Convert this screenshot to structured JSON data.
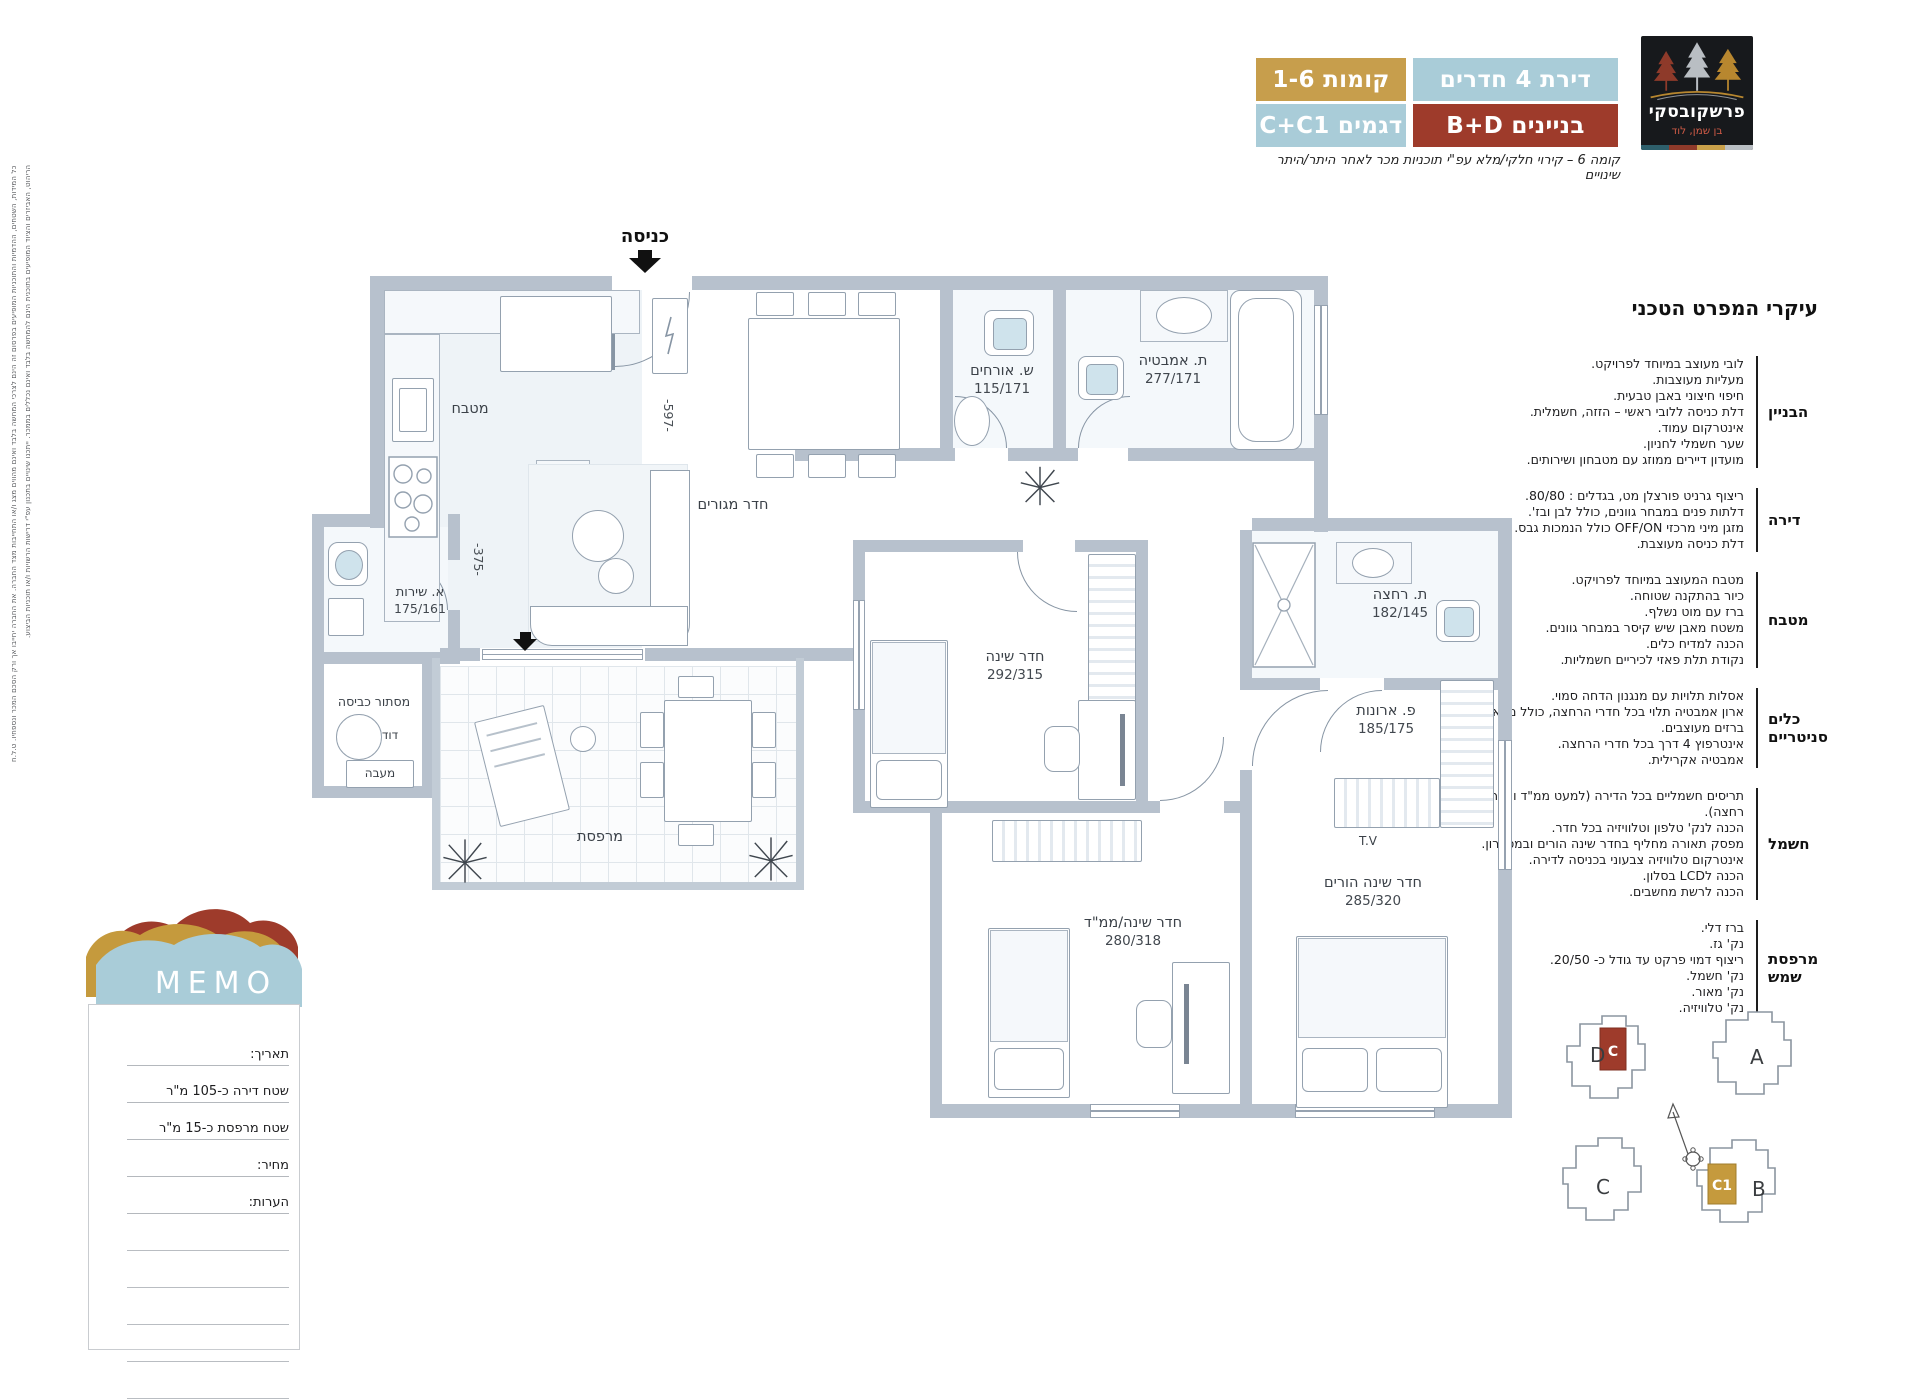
{
  "logo": {
    "brand": "פרשקובסקי",
    "location": "בן שמן, לוד"
  },
  "header": {
    "apartment": "דירת 4 חדרים",
    "floors": "קומות 1-6",
    "buildings": "בניינים B+D",
    "models": "דגמים C+C1",
    "note": "קומה 6 – קירוי חלקי/מלא עפ\"י תוכניות מכר לאחר היתר/היתר שינויים",
    "colors": {
      "blue": "#a9ccd8",
      "gold": "#c79e4c",
      "red": "#9e3b2b"
    }
  },
  "specs": {
    "title": "עיקרי המפרט הטכני",
    "sections": [
      {
        "label": "הבניין",
        "lines": [
          "לובי מעוצב במיוחד לפרויקט.",
          "מעליות מעוצבות.",
          "חיפוי חיצוני באבן טבעית.",
          "דלת כניסה ללובי ראשי – הזזה, חשמלית.",
          "אינטרקום עמוד.",
          "שער חשמלי לחניון.",
          "מועדון דיירים ממוזג עם מטבחון ושירותים."
        ]
      },
      {
        "label": "דירה",
        "lines": [
          "ריצוף גרניט פורצלן מט, בגדלים : 80/80.",
          "דלתות פנים במבחר גוונים, כולל לבן ובז'.",
          "מזגן מיני מרכזי OFF/ON כולל הנמכות גבס.",
          "דלת כניסה מעוצבת."
        ]
      },
      {
        "label": "מטבח",
        "lines": [
          "מטבח המעוצב במיוחד לפרויקט.",
          "כיור בהתקנה שטוחה.",
          "ברז עם מוט נשלף.",
          "משטח מאבן שיש קיסר במבחר גוונים.",
          "הכנה למדיח כלים.",
          "נקודת תלת פאזי לכיריים חשמליות."
        ]
      },
      {
        "label": "כלים סניטריים",
        "lines": [
          "אסלות תלויות עם מנגנון הדחה סמוי.",
          "ארון אמבטיה תלוי בכל חדרי הרחצה, כולל מראה.",
          "ברזים מעוצבים.",
          "אינטרפוץ 4 דרך בכל חדרי הרחצה.",
          "אמבטיה אקרילית."
        ]
      },
      {
        "label": "חשמל",
        "lines": [
          "תריסים חשמליים בכל הדירה (למעט ממ\"ד וחדרי רחצה).",
          "הכנה לנק' טלפון וטלוויזיה בכל חדר.",
          "מפסק תאורה מחליף בחדר שינה הורים ובמסדרון.",
          "אינטרקום טלוויזיה צבעוני בכניסה לדירה.",
          "הכנה לLCD בסלון.",
          "הכנה לרשת מחשבים."
        ]
      },
      {
        "label": "מרפסת שמש",
        "lines": [
          "ברז דלי.",
          "נק' גז.",
          "ריצוף דמוי פרקט עד גודל כ- 20/50.",
          "נק' חשמל.",
          "נק' מאור.",
          "נק' טלוויזיה."
        ]
      }
    ]
  },
  "plan": {
    "entrance": "כניסה",
    "kitchen": "מטבח",
    "living": "חדר מגורים",
    "guest_wc": {
      "name": "ש. אורחים",
      "dim": "115/171"
    },
    "bath": {
      "name": "ת. אמבטיה",
      "dim": "277/171"
    },
    "bedroom": {
      "name": "חדר שינה",
      "dim": "292/315"
    },
    "shower": {
      "name": "ת. רחצה",
      "dim": "182/145"
    },
    "closets": {
      "name": "פ. ארונות",
      "dim": "185/175"
    },
    "service_wc": {
      "name": "א. שירות",
      "dim": "175/161"
    },
    "laundry": "מסתור כביסה",
    "boiler": "דוד",
    "condenser": "מעבה",
    "balcony": "מרפסת",
    "mamad": {
      "name": "חדר שינה/ממ\"ד",
      "dim": "280/318"
    },
    "parents": {
      "name": "חדר שינה הורים",
      "dim": "285/320"
    },
    "tv": "T.V",
    "dim_living": "-597-",
    "dim_hall": "-375-"
  },
  "memo": {
    "title": "MEMO",
    "rows": [
      "תאריך:",
      "שטח דירה כ-105 מ\"ר",
      "שטח מרפסת כ-15 מ\"ר",
      "מחיר:",
      "הערות:"
    ]
  },
  "keyplan": {
    "buildings": {
      "d": "D",
      "a": "A",
      "c": "C",
      "b": "B"
    },
    "units": {
      "c": "C",
      "c1": "C1"
    },
    "colors": {
      "red": "#9e3b2b",
      "gold": "#c59a3d"
    }
  },
  "disclaimer": {
    "line1": "כל המידות, השטחים, ההדמיות והתוכניות המופיעים בפרסום זה הינם לצרכי המחשה בלבד ואינם מהווים מצג ו/או התחייבות מצד החברה. את החברה יחייבו אך ורק הסכם המכר ונספחיו. ט.ל.ח",
    "line2": "הריהוט, האביזרים והציוד המופיעים בתוכנית הינם להמחשה בלבד ואינם נכללים בממכר. ייתכנו שינויים בתכנון עפ\"י דרישות הרשויות ו/או תוכניות הביצוע."
  }
}
